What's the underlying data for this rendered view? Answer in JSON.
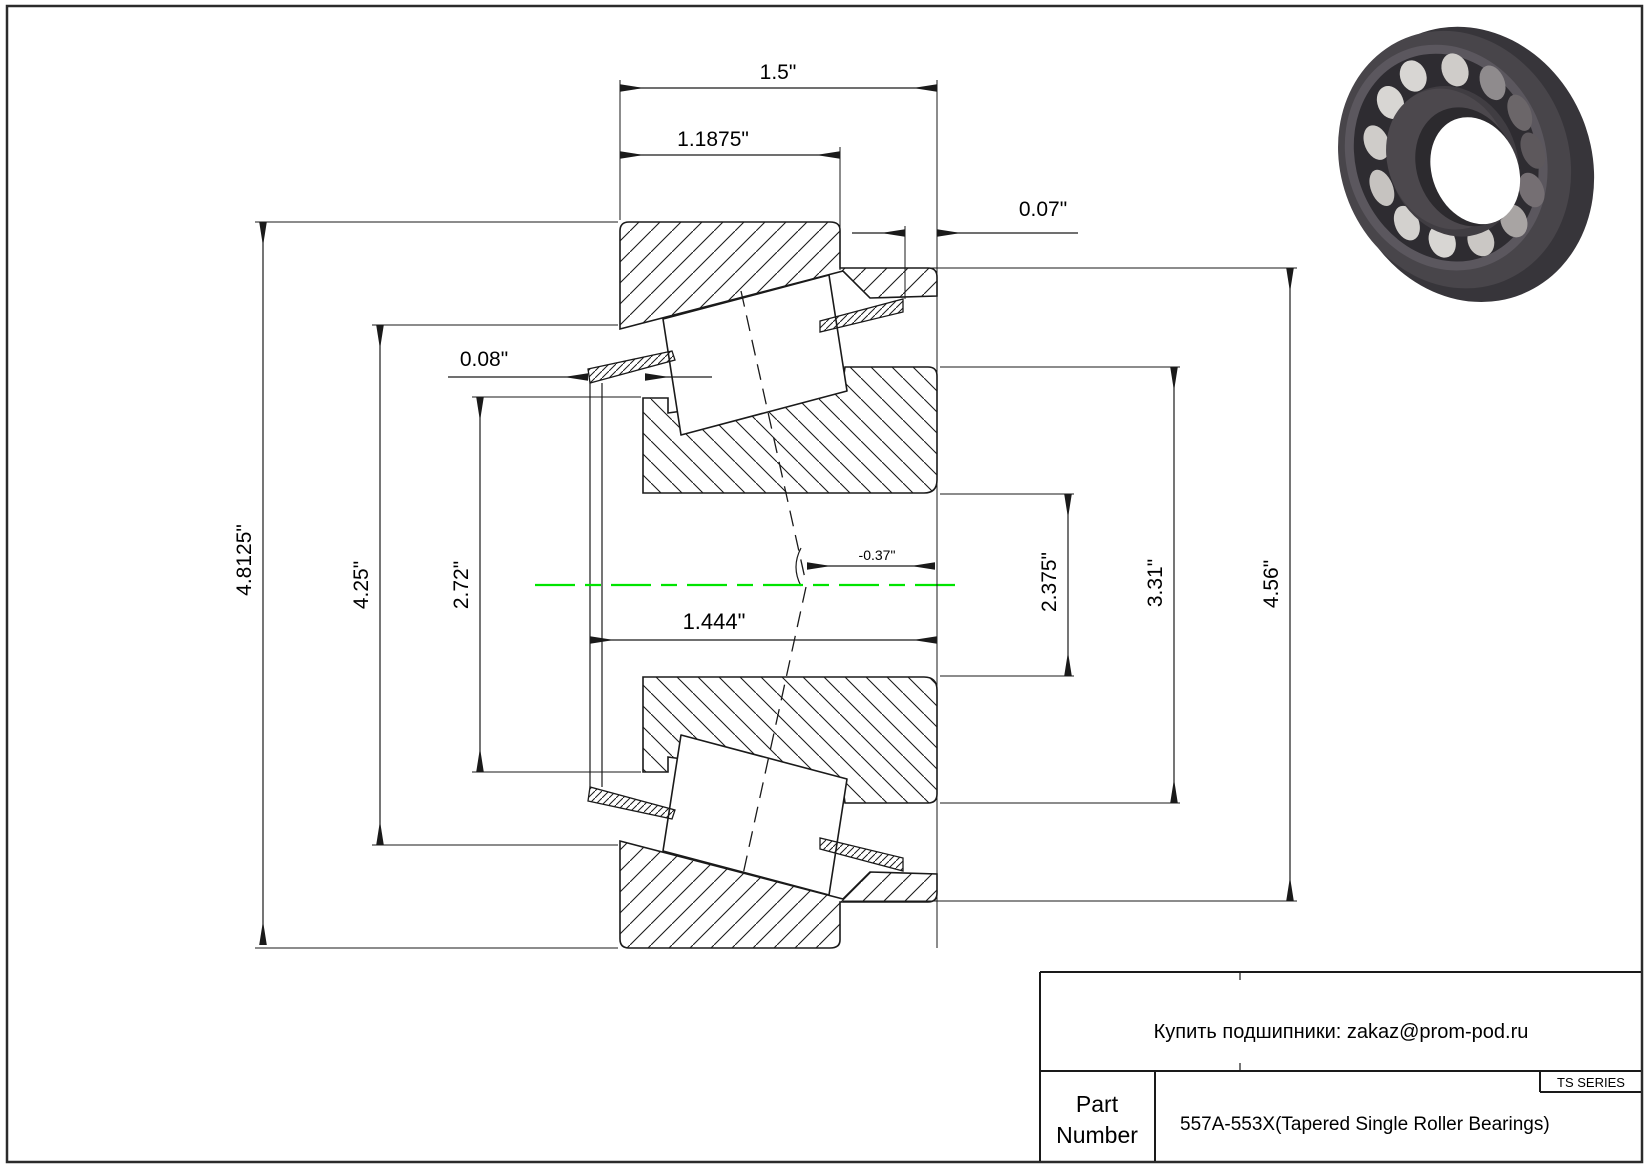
{
  "drawing": {
    "type": "engineering-cross-section",
    "centerline_color": "#00e400",
    "line_color": "#1a1a1a",
    "dimensions": {
      "cup_width": {
        "label": "1.5\""
      },
      "flange_width": {
        "label": "1.1875\""
      },
      "cup_standout": {
        "label": "0.07\""
      },
      "seal_standout": {
        "label": "0.08\""
      },
      "flange_od": {
        "label": "4.8125\""
      },
      "flange_id": {
        "label": "4.25\""
      },
      "cone_front_od": {
        "label": "2.72\""
      },
      "bore": {
        "label": "2.375\""
      },
      "rib_od": {
        "label": "3.31\""
      },
      "cup_od": {
        "label": "4.56\""
      },
      "cone_width": {
        "label": "1.444\""
      },
      "load_center": {
        "label": "-0.37\""
      }
    }
  },
  "title_block": {
    "contact": "Купить подшипники: zakaz@prom-pod.ru",
    "series": "TS SERIES",
    "part_label_line1": "Part",
    "part_label_line2": "Number",
    "part_number": "557A-553X(Tapered Single Roller Bearings)"
  },
  "images": {
    "bearing_render": "3d-tapered-roller-bearing"
  }
}
